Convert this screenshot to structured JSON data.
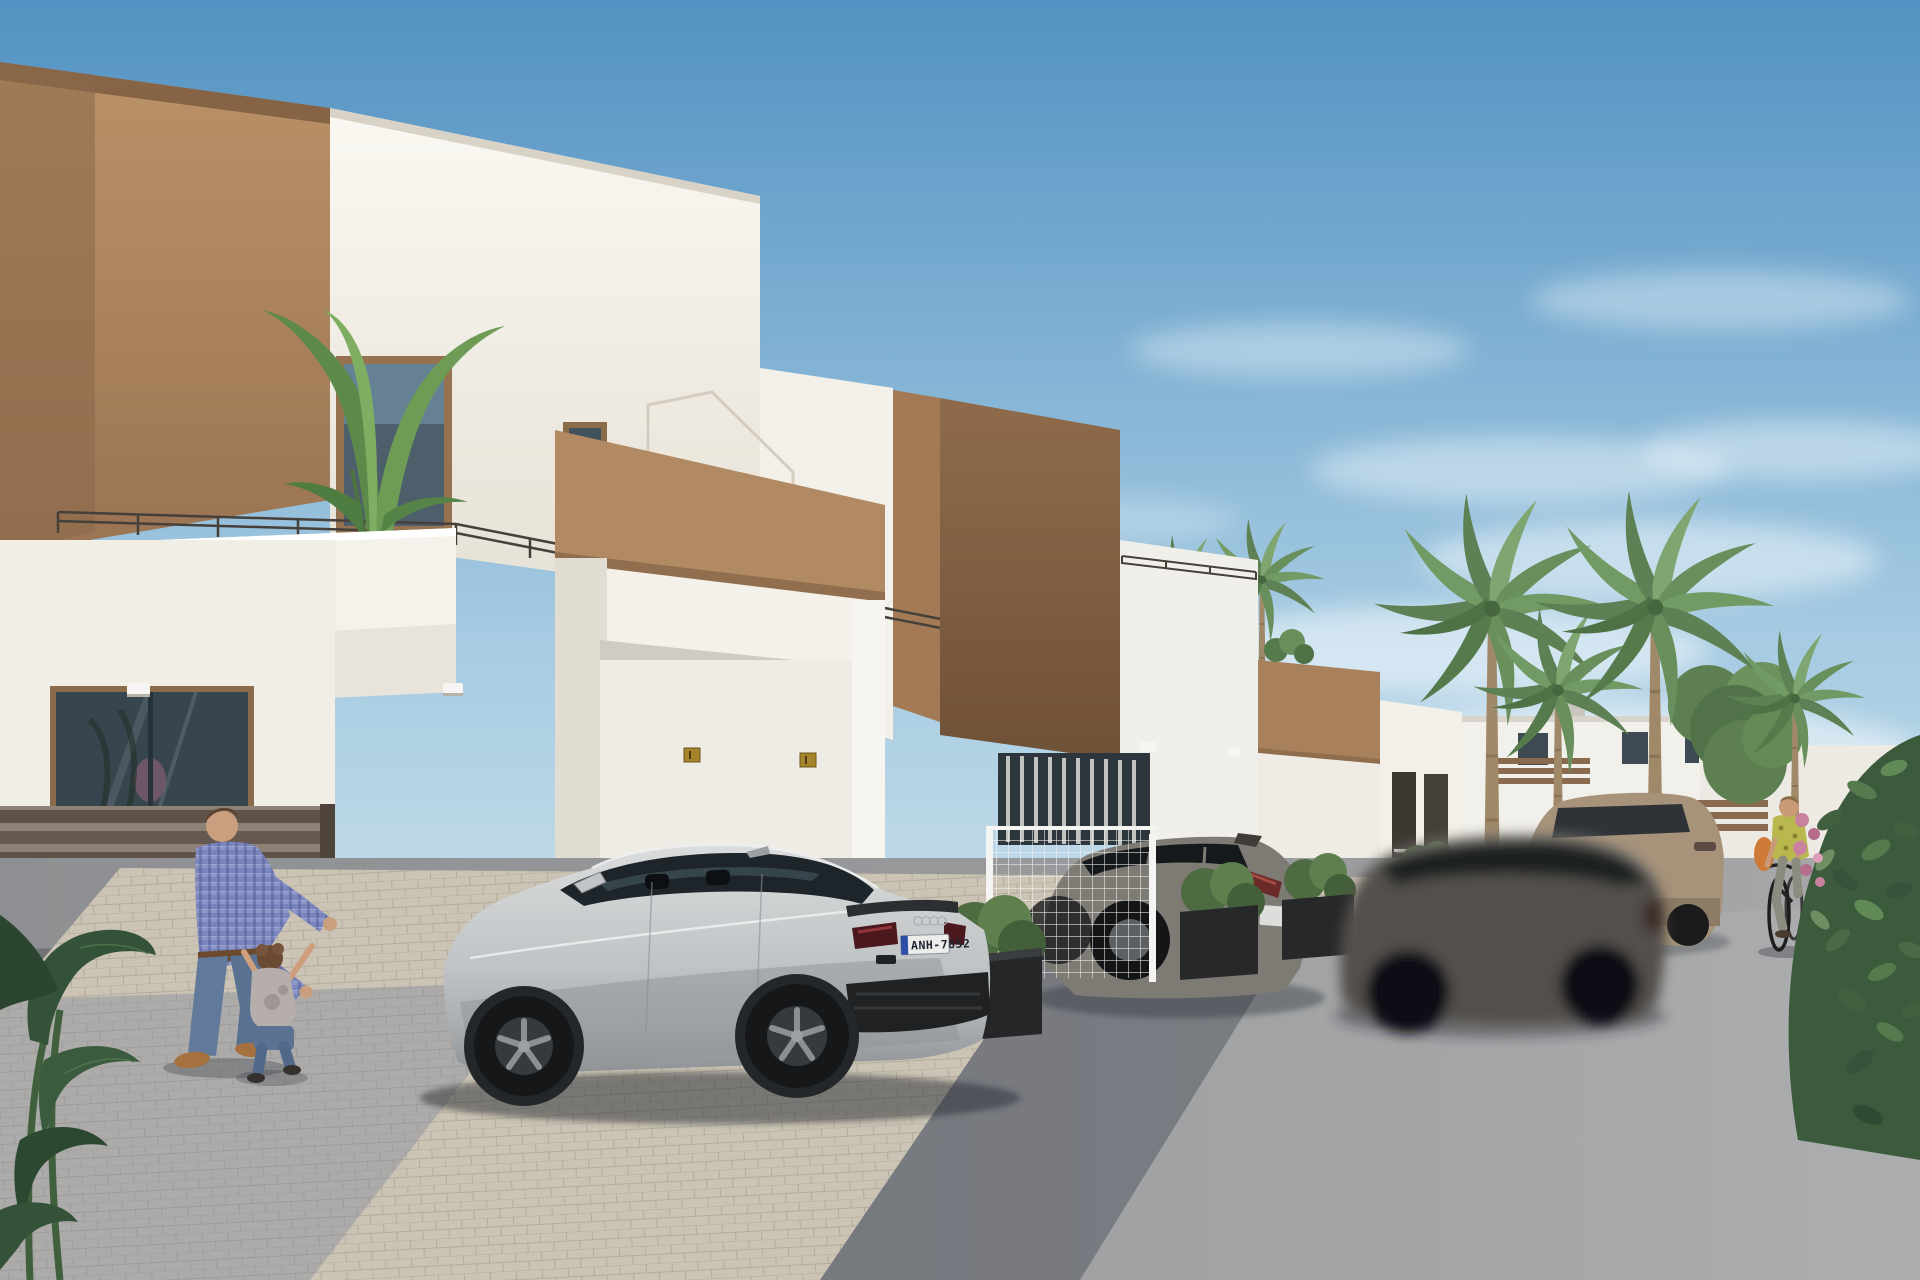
{
  "scene": {
    "type": "exterior-architectural-render",
    "vehicles": {
      "sedan": {
        "license_plate": "ANH-7852",
        "badge": "audi-rings"
      }
    },
    "house_plaques": {
      "count": 2,
      "color": "#a5832a"
    },
    "palette": {
      "sky_top": "#5292c2",
      "sky_mid": "#a6cbe2",
      "sky_horizon": "#e4eef2",
      "wall_white": "#f4f1ea",
      "wall_white_shade": "#e6e1d6",
      "accent_brown": "#b18a63",
      "accent_brown_dark": "#8a6749",
      "glass_dark": "#3a474f",
      "asphalt": "#9b9c9e",
      "asphalt_shadow": "#343a46",
      "cobble": "#cbc3b4",
      "cobble_shade": "#7d8698",
      "palm_green": "#6a9259",
      "bush_green": "#3c5a3c",
      "flower_pink": "#c8829e",
      "sedan_silver": "#c6c9cb",
      "suv_gray": "#7e7a74",
      "moving_car_gray": "#53504c",
      "crossover_beige": "#a6937a",
      "shirt_plaid_blue": "#7a84bd",
      "jeans_blue": "#617a9c",
      "skin": "#c99f80",
      "cyclist_top_yellow": "#b8b84e",
      "bag_orange": "#cc7a36",
      "plate_bg": "#ecedea",
      "plate_text": "#1d2430",
      "plate_eu_blue": "#2b4ea6",
      "gold_plaque": "#a5832a"
    }
  }
}
